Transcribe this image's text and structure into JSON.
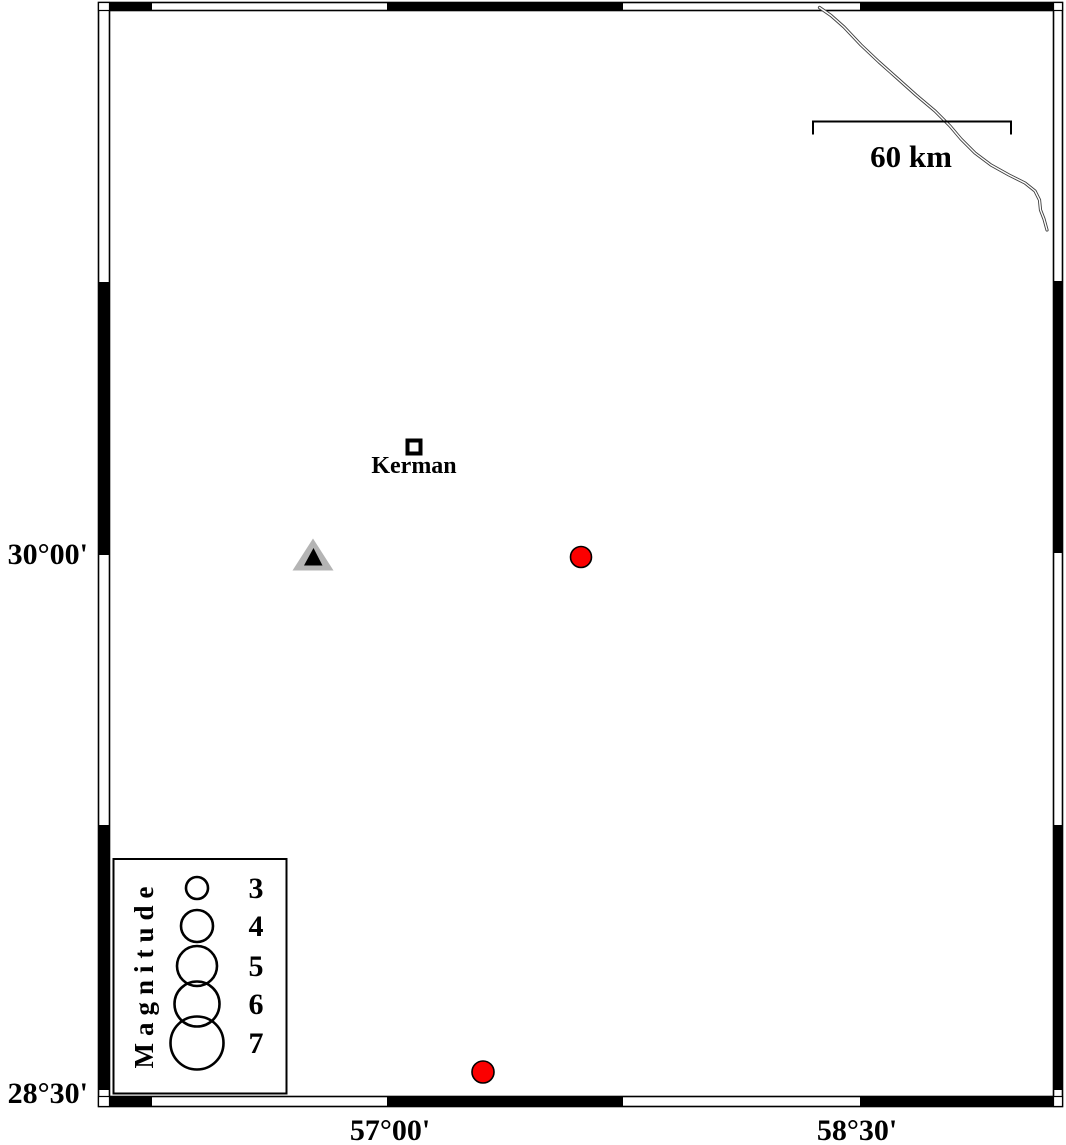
{
  "figure": {
    "type": "seismicity-map",
    "background": "#ffffff",
    "frame_color": "#000000"
  },
  "axis": {
    "lat": [
      {
        "label": "30°00'",
        "y": 555
      },
      {
        "label": "28°30'",
        "y": 1093
      }
    ],
    "lon": [
      {
        "label": "57°00'",
        "x": 390
      },
      {
        "label": "58°30'",
        "x": 857
      }
    ]
  },
  "scalebar": {
    "label": "60 km"
  },
  "city": {
    "name": "Kerman",
    "rect_x": 407.5,
    "rect_y": 440.5,
    "lon_approx": 57.09,
    "lat_approx": 30.3
  },
  "station": {
    "outer_points": "313,538.5 292.5,570.5 333.5,570.5",
    "inner_points": "313.5,548 304,565.5 322.5,565.5",
    "outer_color": "#b4b4b4",
    "inner_color": "#000000",
    "lon_approx": 56.77,
    "lat_approx": 30.0
  },
  "earthquakes": [
    {
      "x": 581,
      "y": 557,
      "r": 10.5,
      "color": "#fb0000",
      "lon_approx": 57.62,
      "lat_approx": 30.0
    },
    {
      "x": 483,
      "y": 1072,
      "r": 11,
      "color": "#fb0000",
      "lon_approx": 57.3,
      "lat_approx": 28.56
    }
  ],
  "road": {
    "path": "M 819.5,7.5 L 831,15.5 L 844,27 L 861,45 L 879,62 L 897,78 L 916,95 L 935,111 L 950,126 L 961,139 L 975,153 L 991,165 L 1009,175 L 1025,183 L 1035,191 L 1039.5,200 L 1040.5,210 L 1044,219 L 1047,230",
    "color": "#3e3e3e"
  },
  "legend": {
    "title": "Magnitude",
    "items": [
      {
        "label": "3",
        "cy": 888,
        "r": 11
      },
      {
        "label": "4",
        "cy": 926,
        "r": 16
      },
      {
        "label": "5",
        "cy": 966,
        "r": 20
      },
      {
        "label": "6",
        "cy": 1004,
        "r": 22.5
      },
      {
        "label": "7",
        "cy": 1043,
        "r": 26.5
      }
    ]
  }
}
